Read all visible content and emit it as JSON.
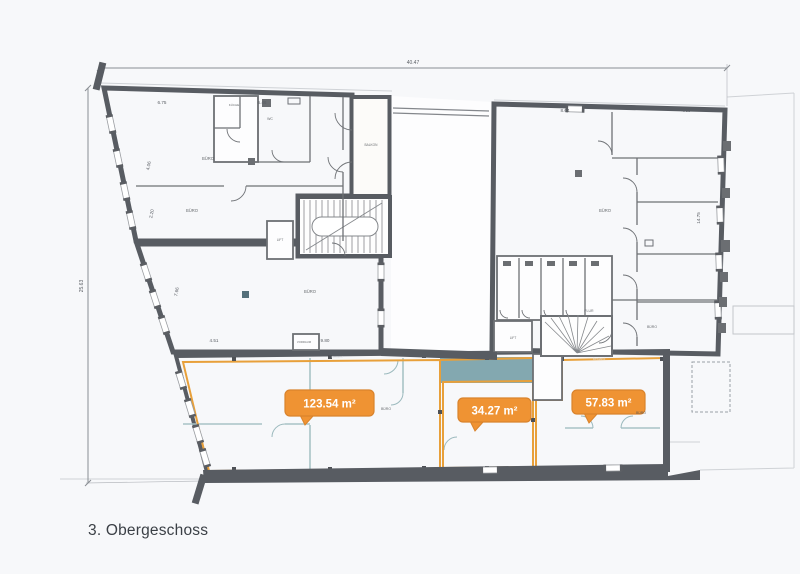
{
  "floor": {
    "label": "3. Obergeschoss"
  },
  "dimensions": {
    "total_width": "40.47",
    "total_side": "25.63"
  },
  "area_badges": [
    {
      "id": "area-left",
      "label": "123.54 m²"
    },
    {
      "id": "area-middle",
      "label": "34.27 m²"
    },
    {
      "id": "area-right",
      "label": "57.83 m²"
    }
  ],
  "dim_labels": [
    {
      "text": "6.75",
      "x": 162,
      "y": 104
    },
    {
      "text": "6.46",
      "x": 262,
      "y": 104
    },
    {
      "text": "8.64",
      "x": 565,
      "y": 112
    },
    {
      "text": "4.60",
      "x": 686,
      "y": 112
    },
    {
      "text": "4.51",
      "x": 214,
      "y": 342
    },
    {
      "text": "9.80",
      "x": 325,
      "y": 342
    },
    {
      "text": "14.75",
      "x": 700,
      "y": 218,
      "r": -90
    },
    {
      "text": "7.66",
      "x": 178,
      "y": 292,
      "r": -79
    },
    {
      "text": "4.06",
      "x": 150,
      "y": 166,
      "r": -78
    },
    {
      "text": "2.20",
      "x": 153,
      "y": 214,
      "r": -78
    }
  ],
  "room_labels": [
    {
      "text": "BÜRO",
      "x": 208,
      "y": 160
    },
    {
      "text": "BÜRO",
      "x": 192,
      "y": 212
    },
    {
      "text": "WC",
      "x": 270,
      "y": 120,
      "s": 3.5
    },
    {
      "text": "KÜCHE",
      "x": 234,
      "y": 106,
      "s": 3
    },
    {
      "text": "BALKON",
      "x": 371,
      "y": 146,
      "s": 3.2
    },
    {
      "text": "LIFT",
      "x": 280,
      "y": 241,
      "s": 3.2
    },
    {
      "text": "BÜRO",
      "x": 310,
      "y": 293
    },
    {
      "text": "VORRAUM",
      "x": 304,
      "y": 343,
      "s": 2.8
    },
    {
      "text": "BÜRO",
      "x": 605,
      "y": 212
    },
    {
      "text": "FLUR",
      "x": 589,
      "y": 312,
      "s": 3.5
    },
    {
      "text": "LIFT",
      "x": 513,
      "y": 339,
      "s": 3.2
    },
    {
      "text": "BÜRO",
      "x": 652,
      "y": 328,
      "s": 3.5
    },
    {
      "text": "BÜRO",
      "x": 386,
      "y": 410,
      "s": 3.5
    },
    {
      "text": "BÜRO",
      "x": 641,
      "y": 414,
      "s": 3.5
    },
    {
      "text": "Bestand",
      "x": 599,
      "y": 360,
      "s": 3.4,
      "c": "#dfe0e3"
    },
    {
      "text": "Bestand",
      "x": 337,
      "y": 358,
      "s": 3.0,
      "c": "#dfe0e3"
    }
  ],
  "colors": {
    "zone_pink": "#d7a49b",
    "zone_red": "#bd7365",
    "zone_teal": "#6f9aa2",
    "zone_teal_light": "#7aa5aa",
    "wall": "#585c62",
    "highlight_orange": "#ef9333",
    "background": "#f7f8fa"
  }
}
